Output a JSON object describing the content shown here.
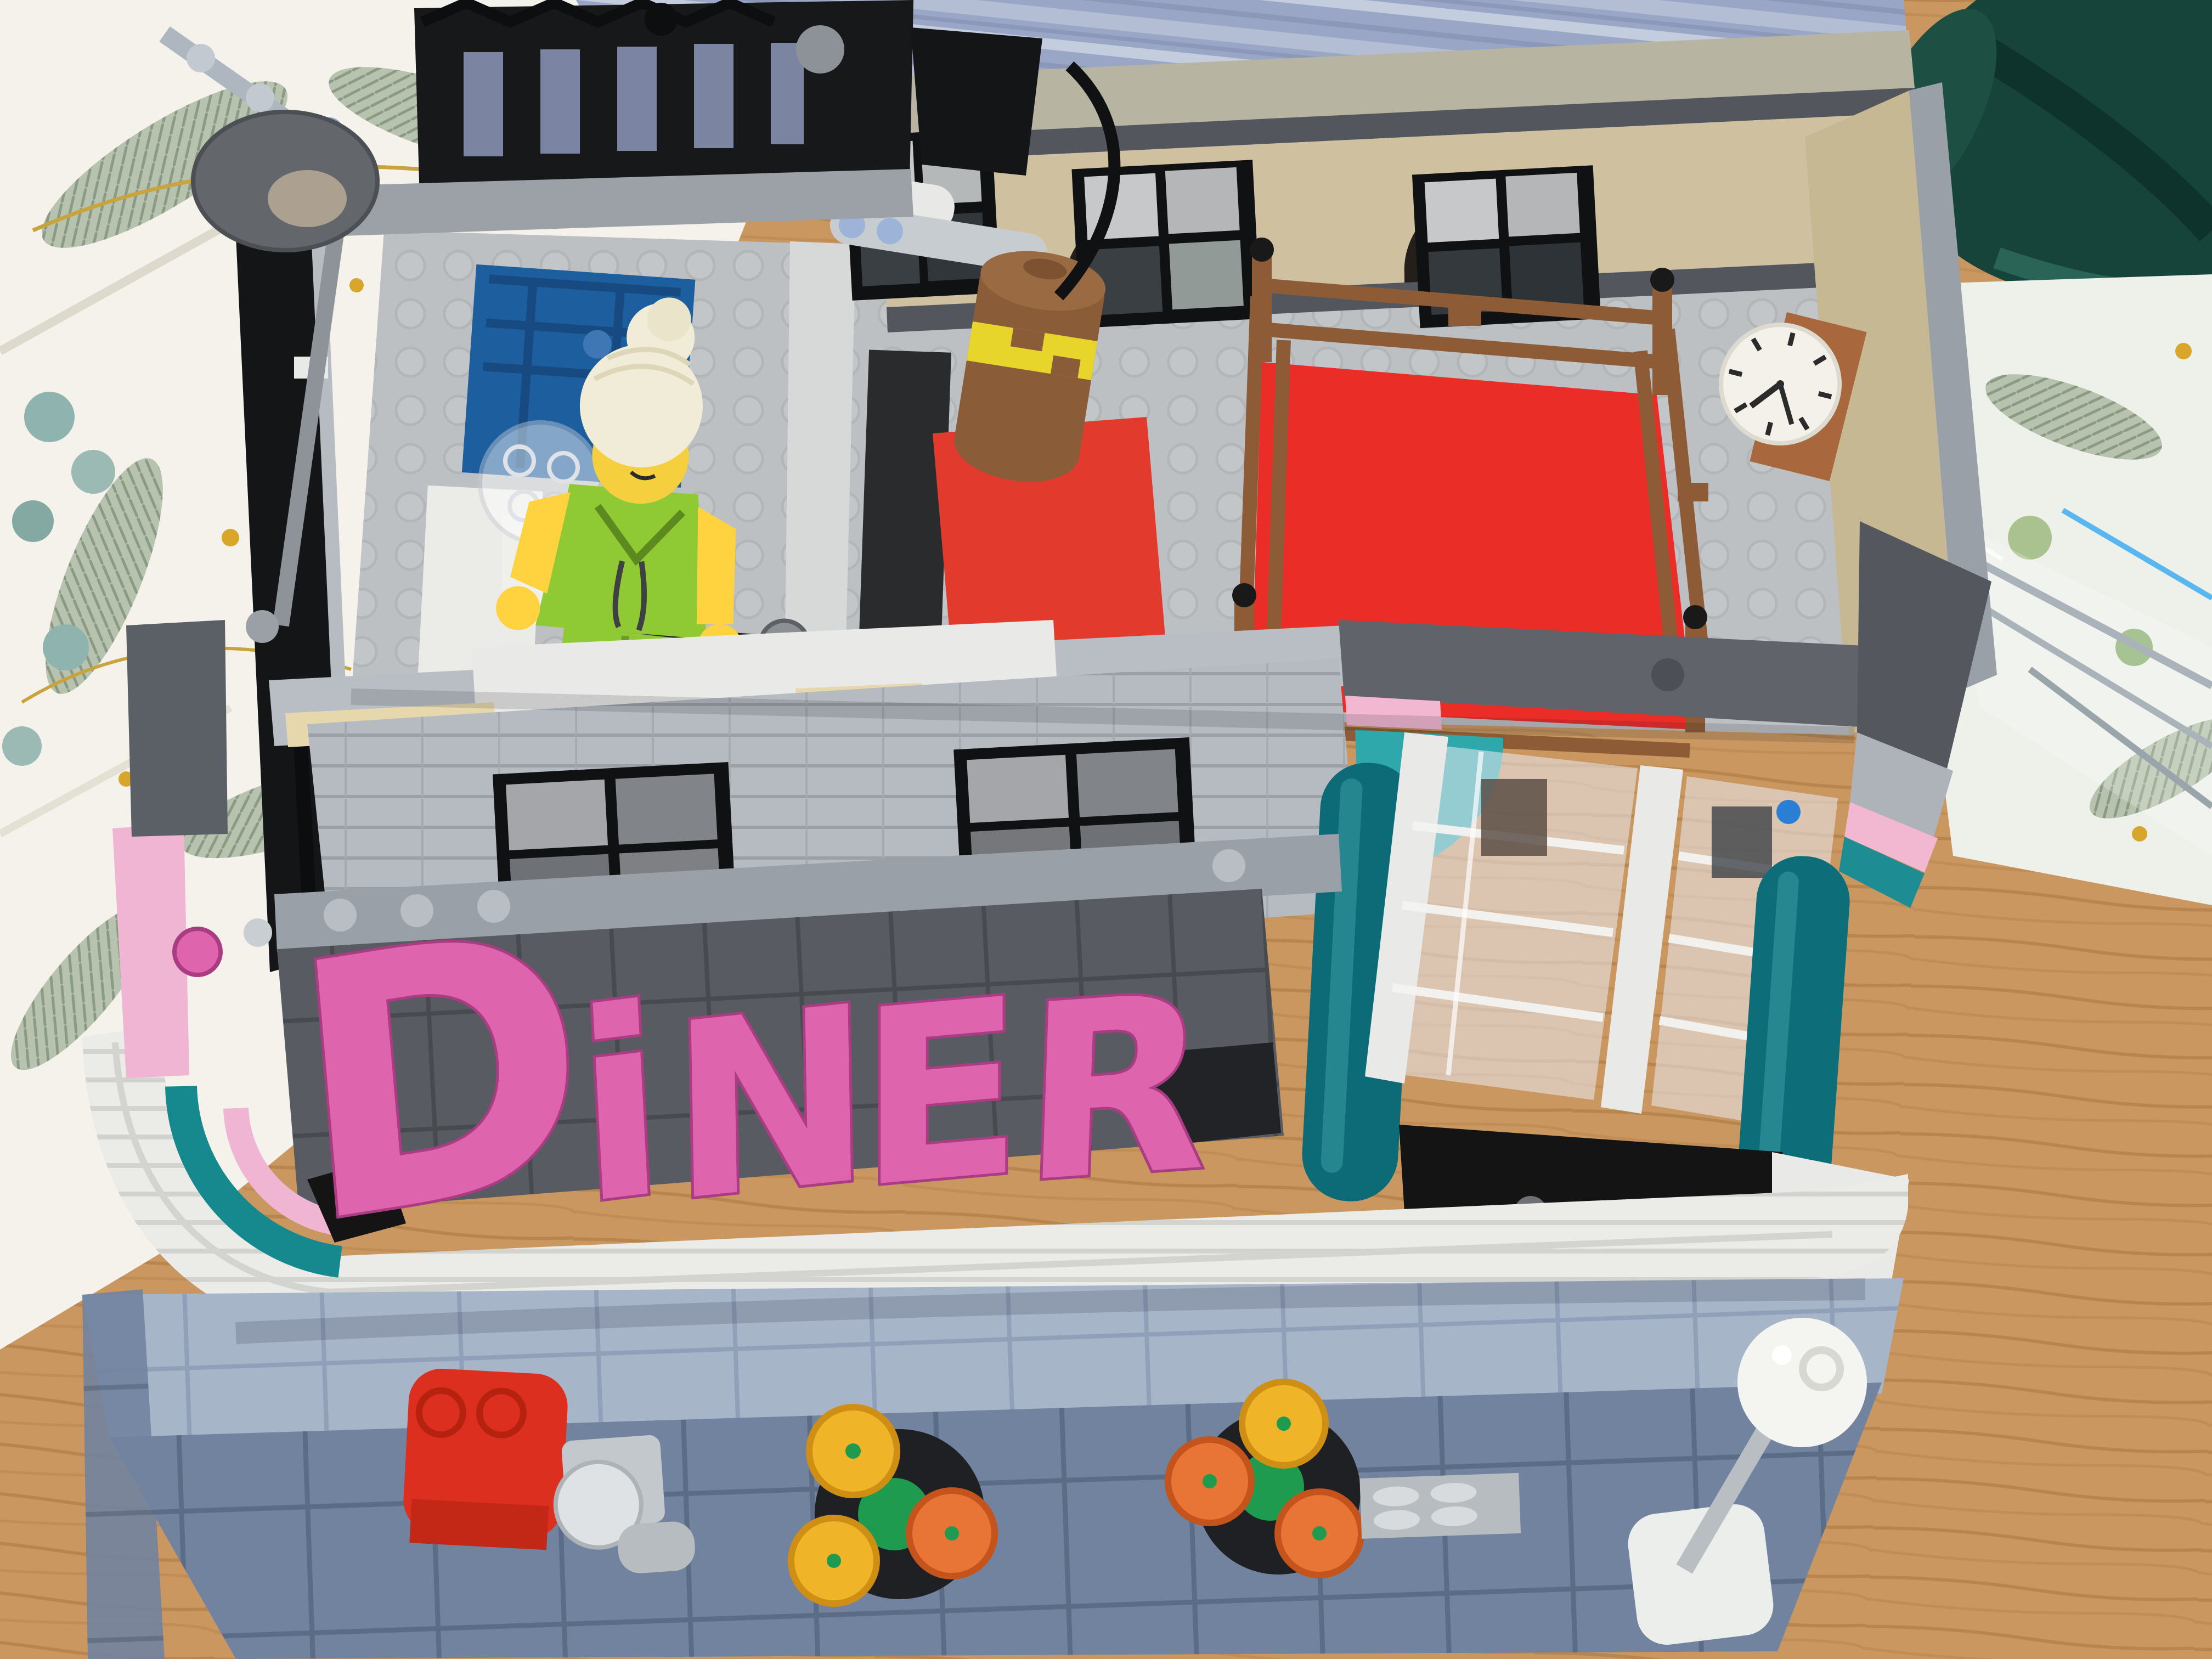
{
  "scene": {
    "title": "Overhead photo of a LEGO retro diner modular building on a table",
    "setting": "tabletop scene: botanical-print napkin, blue striped placemat, dark green felt, glass tray and wooden table around the model"
  },
  "sign": {
    "text": "DINER",
    "letters": [
      "D",
      "i",
      "N",
      "E",
      "R"
    ]
  },
  "clock": {
    "time_shown": "7:25"
  },
  "minifigure": {
    "description": "minifigure with white bun hair, lime hoodie and lime legs standing by a clear-dome dispenser and a dumbbell"
  },
  "interior": {
    "gym": [
      "boxing ring with red mat and reddish-brown ropes",
      "hanging brown punching bag with yellow band",
      "red floor rug",
      "wall clock",
      "arched rear windows with curtains"
    ],
    "left_room": [
      "blue panel door",
      "white counter",
      "transparent dome jug"
    ]
  },
  "street": [
    "red alarm box",
    "gray parking meter",
    "flower planter with yellow and orange flowers",
    "second flower planter",
    "storm grate tile",
    "white globe street lamp",
    "gray dish street lamp on pole"
  ],
  "facade": [
    "pink DINER letter sign on dark tile band",
    "white streamline fascia with grooves",
    "teal quarter-dome awning",
    "dark teal rounded columns",
    "tall transparent diner windows",
    "pink trim stripes",
    "black entrance floor"
  ],
  "colors": {
    "sign-pink": "#df64ae",
    "sign-pink-dark": "#a93c82",
    "awning-teal": "#2fa8ac",
    "column-teal": "#0c6b76",
    "ring-teal": "#15898d",
    "trim-pink": "#f2b8d2",
    "mat-red": "#ea2d26",
    "rug-red": "#e33a2e",
    "rope-brown": "#8d5c36",
    "nougat": "#a8673c",
    "tan-wall": "#cfc0a0",
    "coping-olive": "#b8b4a2",
    "stripe-dark": "#53565c",
    "light-gray": "#b9bec4",
    "mid-gray": "#9aa0a8",
    "dark-gray": "#5d6167",
    "near-black": "#17181a",
    "floor-gray": "#bcc0c3",
    "white-brick": "#ebebe8",
    "lime": "#8fc934",
    "minifig-yellow": "#ffd23f",
    "hair-white": "#f1ecd8",
    "door-blue": "#1d5e9e",
    "road-blue": "#71839f",
    "sidewalk-blue": "#a7b5c9",
    "wood": "#c9975f",
    "placemat-blue": "#9aa6c6",
    "felt-green": "#16443b",
    "napkin-white": "#f4f2ea",
    "flower-yellow": "#f0b429",
    "flower-orange": "#e87436",
    "flower-green": "#1e9b4e",
    "box-red": "#dd2f1f"
  }
}
